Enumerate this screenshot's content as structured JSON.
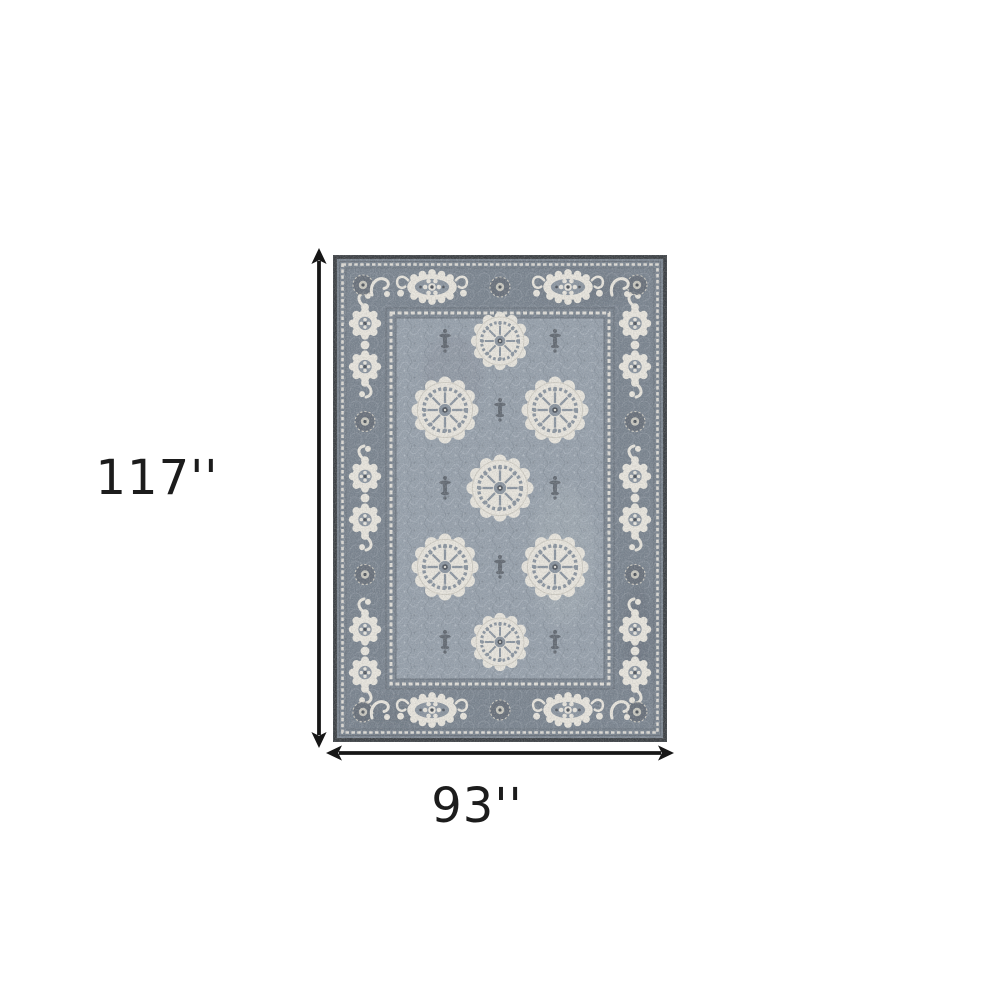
{
  "diagram": {
    "height_label": "117''",
    "width_label": "93''"
  },
  "icons": {
    "height_arrow": "vertical-double-headed-arrow",
    "width_arrow": "horizontal-double-headed-arrow"
  },
  "colors": {
    "bg": "#ffffff",
    "label": "#1c1c1c",
    "arrow": "#161616",
    "edge": "#43474b",
    "band": "#7b8590",
    "field": "#97a1ac",
    "ivory": "#e9e6de",
    "shade": "#cfccc3",
    "detail": "#8b95a0",
    "dark": "#50565e",
    "dark2": "#666e78"
  }
}
